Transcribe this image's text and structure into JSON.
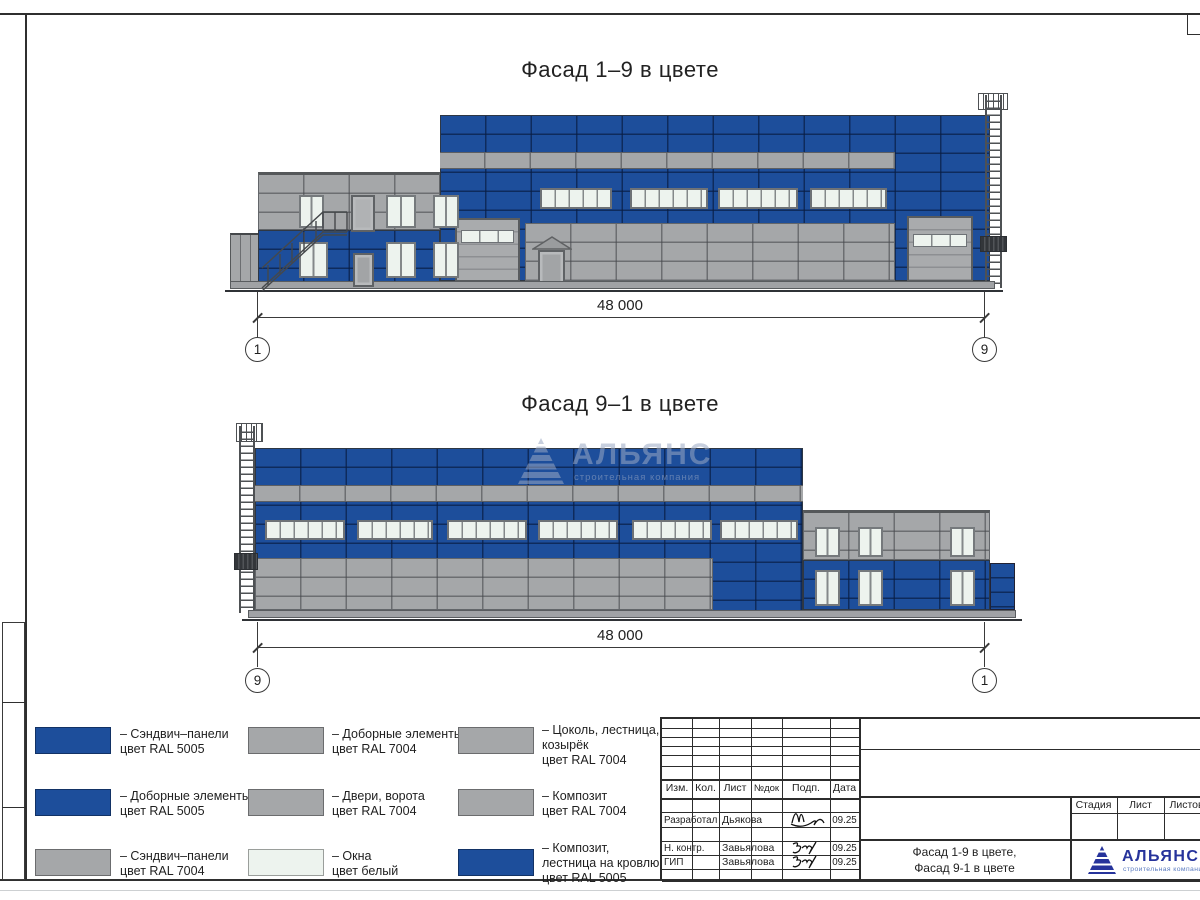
{
  "colors": {
    "panel_blue": "#1d4e9b",
    "panel_gray": "#a5a7a9",
    "window_white": "#edf3ee",
    "logo_blue": "#26339b"
  },
  "titles": {
    "facade1": "Фасад 1–9 в цвете",
    "facade2": "Фасад 9–1 в цвете"
  },
  "dimensions": {
    "facade1": {
      "length": "48 000",
      "axis_left": "1",
      "axis_right": "9"
    },
    "facade2": {
      "length": "48 000",
      "axis_left": "9",
      "axis_right": "1"
    }
  },
  "legend": {
    "items": [
      {
        "color": "#1d4e9b",
        "lines": [
          "– Сэндвич–панели",
          "цвет RAL 5005",
          ""
        ]
      },
      {
        "color": "#1d4e9b",
        "lines": [
          "– Доборные элементы",
          "цвет RAL 5005",
          ""
        ]
      },
      {
        "color": "#a5a7a9",
        "lines": [
          "– Сэндвич–панели",
          "цвет RAL 7004",
          ""
        ]
      },
      {
        "color": "#a5a7a9",
        "lines": [
          "– Доборные элементы",
          "цвет RAL 7004",
          ""
        ]
      },
      {
        "color": "#a5a7a9",
        "lines": [
          "– Двери, ворота",
          "цвет RAL 7004",
          ""
        ]
      },
      {
        "color": "#edf3ee",
        "lines": [
          "– Окна",
          "цвет белый",
          ""
        ]
      },
      {
        "color": "#a5a7a9",
        "lines": [
          "– Цоколь, лестница,",
          "козырёк",
          "цвет RAL 7004"
        ]
      },
      {
        "color": "#a5a7a9",
        "lines": [
          "– Композит",
          "цвет RAL 7004",
          ""
        ]
      },
      {
        "color": "#1d4e9b",
        "lines": [
          "– Композит,",
          "лестница на кровлю",
          "цвет RAL 5005"
        ]
      }
    ]
  },
  "watermark": {
    "name": "АЛЬЯНС",
    "tagline": "строительная компания"
  },
  "titleblock": {
    "header": {
      "izm": "Изм.",
      "kol": "Кол.",
      "list": "Лист",
      "ndok": "№док",
      "podp": "Подп.",
      "data": "Дата"
    },
    "rows": [
      {
        "role": "Разработал",
        "name": "Дьякова",
        "date": "09.25"
      },
      {
        "role": "Н. контр.",
        "name": "Завьялова",
        "date": "09.25"
      },
      {
        "role": "ГИП",
        "name": "Завьялова",
        "date": "09.25"
      }
    ],
    "stage": {
      "stadia": "Стадия",
      "list": "Лист",
      "listov": "Листов"
    },
    "sheet_title_line1": "Фасад 1-9 в цвете,",
    "sheet_title_line2": "Фасад 9-1 в цвете",
    "logo": {
      "name": "АЛЬЯНС",
      "tagline": "строительная компания"
    }
  }
}
